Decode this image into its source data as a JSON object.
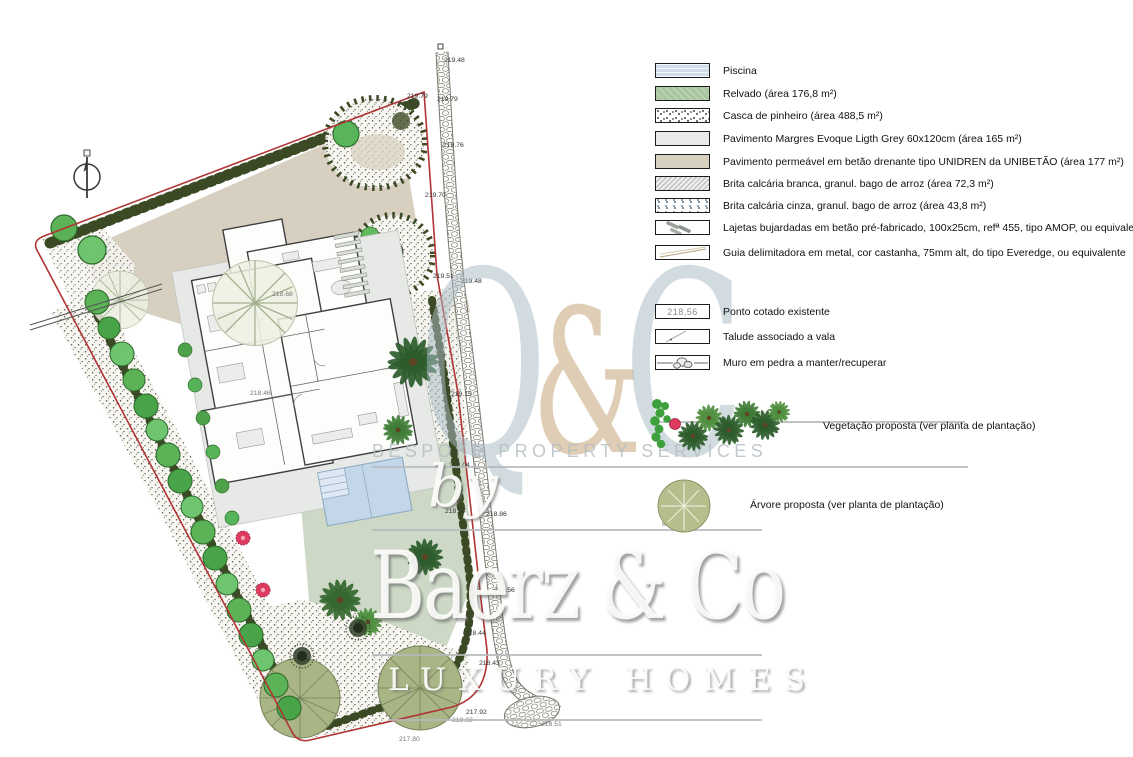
{
  "legend": {
    "materials": [
      {
        "swatch": "piscina",
        "label": "Piscina"
      },
      {
        "swatch": "relvado",
        "label": "Relvado (área 176,8 m²)"
      },
      {
        "swatch": "casca",
        "label": "Casca de pinheiro (área 488,5 m²)"
      },
      {
        "swatch": "margres",
        "label": "Pavimento Margres Evoque Ligth Grey 60x120cm (área 165 m²)"
      },
      {
        "swatch": "unidren",
        "label": "Pavimento permeável em betão drenante tipo UNIDREN da UNIBETÃO (área 177 m²)"
      },
      {
        "swatch": "brita-branca",
        "label": "Brita calcária branca, granul. bago de arroz (área 72,3 m²)"
      },
      {
        "swatch": "brita-cinza",
        "label": "Brita calcária cinza, granul. bago de arroz (área 43,8 m²)"
      },
      {
        "swatch": "lajetas",
        "label": "Lajetas bujardadas em betão pré-fabricado, 100x25cm, refª 455, tipo AMOP, ou equivalente"
      },
      {
        "swatch": "guia",
        "label": "Guia delimitadora em metal, cor castanha, 75mm alt, do tipo Everedge, ou equivalente"
      }
    ],
    "symbols": [
      {
        "sample": "218,56",
        "label": "Ponto cotado existente"
      },
      {
        "label": "Talude associado a vala"
      },
      {
        "label": "Muro em pedra a manter/recuperar"
      }
    ],
    "vegetation": [
      {
        "label": "Vegetação proposta (ver planta de plantação)"
      },
      {
        "label": "Árvore proposta (ver planta de plantação)"
      }
    ]
  },
  "plan": {
    "spot_elevations": [
      "219.48",
      "219.79",
      "219.79",
      "219.76",
      "219.70",
      "219.51",
      "219.48",
      "219.15",
      "219.04",
      "218.57",
      "218.86",
      "218.56",
      "218.44",
      "218.43",
      "217.92",
      "218.02",
      "218.51",
      "217.80",
      "218.68",
      "218.46"
    ]
  },
  "watermark": {
    "logo_parts": [
      "Q",
      "&",
      "C"
    ],
    "tagline": "BESPOKE PROPERTY SERVICES",
    "by": "by",
    "brand": "Baerz & Co",
    "subbrand": "LUXURY HOMES"
  },
  "colors": {
    "boundary_red": "#b03434",
    "hedge_green": "#3b4a24",
    "lawn_green": "#cdd9c6",
    "paving_tan": "#d7d0c0",
    "paving_grey": "#e6e9e5",
    "pool_blue": "#c3d7e8",
    "tree_green": "#5cb357",
    "flower_pink": "#df3b60",
    "watermark_grey": "#aebec8",
    "watermark_tan": "#cfae8c"
  }
}
